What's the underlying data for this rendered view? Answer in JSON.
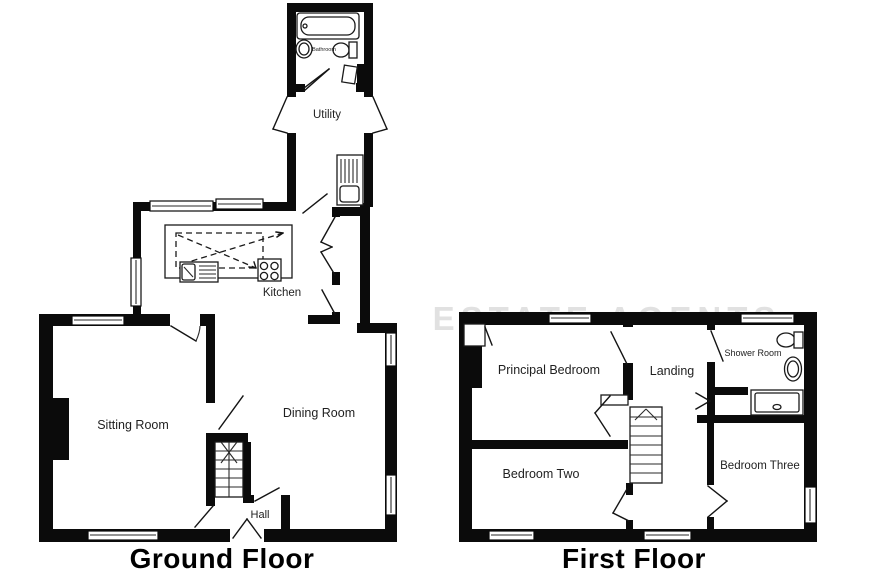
{
  "watermark": "ESTATE AGENTS",
  "colors": {
    "wall": "#0b0b0b",
    "background": "#ffffff",
    "line": "#1a1a1a",
    "watermark": "#c9c9c9"
  },
  "floors": {
    "ground": {
      "title": "Ground Floor",
      "rooms": {
        "bathroom": "Bathroom",
        "utility": "Utility",
        "kitchen": "Kitchen",
        "sitting": "Sitting Room",
        "dining": "Dining Room",
        "hall": "Hall"
      }
    },
    "first": {
      "title": "First Floor",
      "rooms": {
        "principal": "Principal Bedroom",
        "landing": "Landing",
        "shower": "Shower Room",
        "bedroom_two": "Bedroom Two",
        "bedroom_three": "Bedroom Three"
      }
    }
  }
}
